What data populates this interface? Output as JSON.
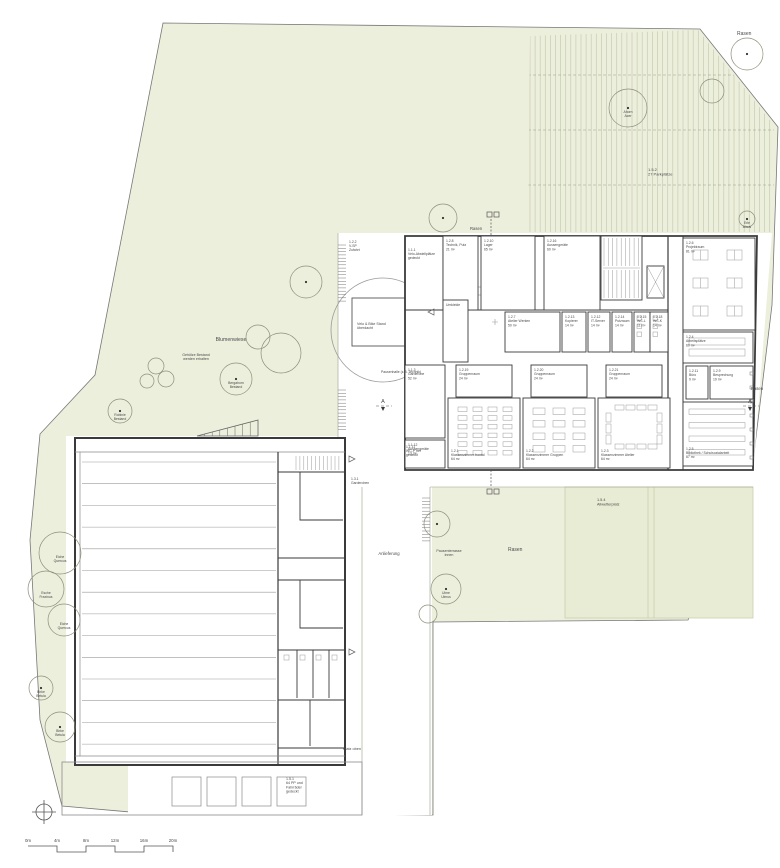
{
  "title": "Situationsplan Schulanlage",
  "colors": {
    "site_green": "#edefdd",
    "allweather_green": "#e8ecd4",
    "allweather_border": "#c9cfad",
    "stripe": "#c6cbb2",
    "wall": "#3a3a3a",
    "thin": "#8a8a8a",
    "furniture": "#9a9a9a",
    "text": "#4a4a4a",
    "edge": "#b9bfa4"
  },
  "section_markers": [
    "A",
    "A"
  ],
  "scale_bar": {
    "ticks": [
      "0m",
      "4m",
      "8m",
      "12m",
      "16m",
      "20m"
    ]
  },
  "labels": [
    {
      "x": 737,
      "y": 35,
      "s": 5,
      "t": [
        "Rasen"
      ]
    },
    {
      "x": 648,
      "y": 171,
      "s": 4,
      "t": [
        "1.5.2",
        "27 Parkplätze"
      ]
    },
    {
      "x": 470,
      "y": 230,
      "s": 4.2,
      "t": [
        "Rasen"
      ]
    },
    {
      "x": 231,
      "y": 341,
      "s": 5.2,
      "a": "m",
      "t": [
        "Blumenwiese"
      ]
    },
    {
      "x": 196,
      "y": 356,
      "s": 3.6,
      "a": "m",
      "t": [
        "Gehölze Bestand",
        "werden erhalten"
      ]
    },
    {
      "x": 508,
      "y": 551,
      "s": 5,
      "t": [
        "Rasen"
      ]
    },
    {
      "x": 757,
      "y": 390,
      "s": 4.2,
      "a": "m",
      "t": [
        "Rasen"
      ]
    },
    {
      "x": 597,
      "y": 501,
      "s": 3.8,
      "t": [
        "1.5.4",
        "Allwetterplatz"
      ]
    },
    {
      "x": 389,
      "y": 555,
      "s": 4.2,
      "a": "m",
      "t": [
        "Anlieferung"
      ]
    },
    {
      "x": 449,
      "y": 552,
      "s": 3.6,
      "a": "m",
      "t": [
        "Pausenterrasse",
        "innen"
      ]
    },
    {
      "x": 343,
      "y": 750,
      "s": 3.8,
      "t": [
        "Platz oben"
      ]
    },
    {
      "x": 286,
      "y": 780,
      "s": 3.6,
      "t": [
        "1.5.1",
        "64 PP und",
        "Fahrräder",
        "gedeckt"
      ]
    },
    {
      "x": 349,
      "y": 243,
      "s": 3.4,
      "t": [
        "1.2.2",
        "V-SP",
        "Zufahrt"
      ]
    },
    {
      "x": 357,
      "y": 325,
      "s": 3.6,
      "t": [
        "Velo & Bike Stand",
        "überdacht"
      ]
    },
    {
      "x": 381,
      "y": 373,
      "s": 3.4,
      "t": [
        "Pausenhalle (z.B. Technik)"
      ]
    },
    {
      "x": 351,
      "y": 480,
      "s": 3.4,
      "t": [
        "1.3.1",
        "Garderoben"
      ]
    },
    {
      "x": 408,
      "y": 251,
      "s": 3.4,
      "t": [
        "1.1.1",
        "Velo-Abstellplätze",
        "gedeckt"
      ]
    },
    {
      "x": 406,
      "y": 448,
      "s": 3.4,
      "t": [
        "1.1.11",
        "WC-P frei",
        "gedeckt"
      ]
    }
  ],
  "trees": [
    {
      "x": 747,
      "y": 54,
      "r": 16,
      "d": 1
    },
    {
      "x": 712,
      "y": 91,
      "r": 12,
      "d": 0
    },
    {
      "x": 628,
      "y": 108,
      "r": 19,
      "d": 1,
      "t": [
        "Ahorn",
        "Acer"
      ]
    },
    {
      "x": 443,
      "y": 218,
      "r": 14,
      "d": 1
    },
    {
      "x": 747,
      "y": 219,
      "r": 8,
      "d": 1,
      "t": [
        "Erle",
        "Alnus"
      ]
    },
    {
      "x": 306,
      "y": 282,
      "r": 16,
      "d": 1
    },
    {
      "x": 281,
      "y": 353,
      "r": 20,
      "d": 0
    },
    {
      "x": 258,
      "y": 337,
      "r": 12,
      "d": 0
    },
    {
      "x": 236,
      "y": 379,
      "r": 16,
      "d": 1,
      "t": [
        "Bergahorn",
        "Bestand"
      ]
    },
    {
      "x": 156,
      "y": 366,
      "r": 8,
      "d": 0
    },
    {
      "x": 147,
      "y": 381,
      "r": 7,
      "d": 0
    },
    {
      "x": 166,
      "y": 379,
      "r": 8,
      "d": 0
    },
    {
      "x": 120,
      "y": 411,
      "r": 12,
      "d": 1,
      "t": [
        "Robinie",
        "Bestand"
      ]
    },
    {
      "x": 60,
      "y": 553,
      "r": 21,
      "d": 0,
      "t": [
        "Eiche",
        "Quercus"
      ]
    },
    {
      "x": 46,
      "y": 589,
      "r": 18,
      "d": 0,
      "t": [
        "Esche",
        "Fraxinus"
      ]
    },
    {
      "x": 64,
      "y": 620,
      "r": 16,
      "d": 0,
      "t": [
        "Eiche",
        "Quercus"
      ]
    },
    {
      "x": 41,
      "y": 688,
      "r": 12,
      "d": 1,
      "t": [
        "Birke",
        "Betula"
      ]
    },
    {
      "x": 60,
      "y": 727,
      "r": 15,
      "d": 1,
      "t": [
        "Birke",
        "Betula"
      ]
    },
    {
      "x": 437,
      "y": 524,
      "r": 13,
      "d": 1
    },
    {
      "x": 446,
      "y": 589,
      "r": 15,
      "d": 1,
      "t": [
        "Ulme",
        "Ulmus"
      ]
    },
    {
      "x": 428,
      "y": 614,
      "r": 9,
      "d": 0
    }
  ],
  "rooms": [
    {
      "x": 443,
      "y": 236,
      "w": 35,
      "h": 74,
      "l": [
        "1.2.8",
        "Technik, Putz",
        "21 m²"
      ]
    },
    {
      "x": 481,
      "y": 236,
      "w": 54,
      "h": 74,
      "l": [
        "1.2.10",
        "Lager",
        "65 m²"
      ]
    },
    {
      "x": 544,
      "y": 236,
      "w": 56,
      "h": 74,
      "l": [
        "1.2.16",
        "Aussengeräte",
        "60 m²"
      ]
    },
    {
      "x": 601,
      "y": 236,
      "w": 41,
      "h": 64,
      "f": "stair"
    },
    {
      "x": 647,
      "y": 266,
      "w": 17,
      "h": 32,
      "f": "lift"
    },
    {
      "x": 683,
      "y": 238,
      "w": 72,
      "h": 92,
      "f": "groups",
      "l": [
        "1.2.6",
        "Projektraum",
        "81 m²"
      ]
    },
    {
      "x": 683,
      "y": 332,
      "w": 70,
      "h": 31,
      "f": "tables2",
      "l": [
        "1.2.4",
        "Arbeitsplätze",
        "60 m²"
      ]
    },
    {
      "x": 686,
      "y": 366,
      "w": 22,
      "h": 33,
      "l": [
        "1.2.11",
        "Büro",
        "9 m²"
      ]
    },
    {
      "x": 710,
      "y": 366,
      "w": 43,
      "h": 33,
      "l": [
        "1.2.9",
        "Besprechung",
        "19 m²"
      ]
    },
    {
      "x": 683,
      "y": 402,
      "w": 70,
      "h": 64,
      "f": "shelves",
      "lpos": "b",
      "l": [
        "1.2.5",
        "Bibliothek / Schulsozialarbeit",
        "87 m²"
      ]
    },
    {
      "x": 505,
      "y": 312,
      "w": 55,
      "h": 40,
      "l": [
        "1.2.7",
        "Atelier Werken",
        "50 m²"
      ]
    },
    {
      "x": 562,
      "y": 312,
      "w": 24,
      "h": 40,
      "l": [
        "1.2.13",
        "Kopierer",
        "14 m²"
      ]
    },
    {
      "x": 588,
      "y": 312,
      "w": 22,
      "h": 40,
      "l": [
        "1.2.12",
        "IT-Server",
        "14 m²"
      ]
    },
    {
      "x": 612,
      "y": 312,
      "w": 20,
      "h": 40,
      "l": [
        "1.2.14",
        "Putzraum",
        "14 m²"
      ]
    },
    {
      "x": 634,
      "y": 312,
      "w": 16,
      "h": 40,
      "f": "wc",
      "l": [
        "1.2.15",
        "WC-L",
        "11 m²"
      ]
    },
    {
      "x": 650,
      "y": 312,
      "w": 18,
      "h": 40,
      "f": "wc",
      "l": [
        "1.2.18",
        "WC-K",
        "14 m²"
      ]
    },
    {
      "x": 443,
      "y": 300,
      "w": 25,
      "h": 62,
      "l": [
        "Umkleide"
      ]
    },
    {
      "x": 405,
      "y": 365,
      "w": 40,
      "h": 73,
      "l": [
        "1.1.3",
        "Garderobe",
        "52 m²"
      ]
    },
    {
      "x": 405,
      "y": 440,
      "w": 40,
      "h": 28,
      "l": [
        "1.1.12",
        "Aussengeräte",
        "13 m²"
      ]
    },
    {
      "x": 456,
      "y": 365,
      "w": 56,
      "h": 32,
      "l": [
        "1.2.19",
        "Gruppenraum",
        "24 m²"
      ]
    },
    {
      "x": 531,
      "y": 365,
      "w": 56,
      "h": 32,
      "l": [
        "1.2.20",
        "Gruppenraum",
        "24 m²"
      ]
    },
    {
      "x": 606,
      "y": 365,
      "w": 56,
      "h": 32,
      "l": [
        "1.2.21",
        "Gruppenraum",
        "24 m²"
      ]
    },
    {
      "x": 448,
      "y": 398,
      "w": 72,
      "h": 70,
      "f": "rows",
      "lpos": "b",
      "l": [
        "1.2.1",
        "Klassenzimmer frontal",
        "64 m²"
      ]
    },
    {
      "x": 523,
      "y": 398,
      "w": 72,
      "h": 70,
      "f": "clusters",
      "lpos": "b",
      "l": [
        "1.2.2",
        "Klassenzimmer Gruppen",
        "64 m²"
      ]
    },
    {
      "x": 598,
      "y": 398,
      "w": 72,
      "h": 70,
      "f": "ushape",
      "lpos": "b",
      "l": [
        "1.2.3",
        "Klassenzimmer Atelier",
        "64 m²"
      ]
    }
  ]
}
